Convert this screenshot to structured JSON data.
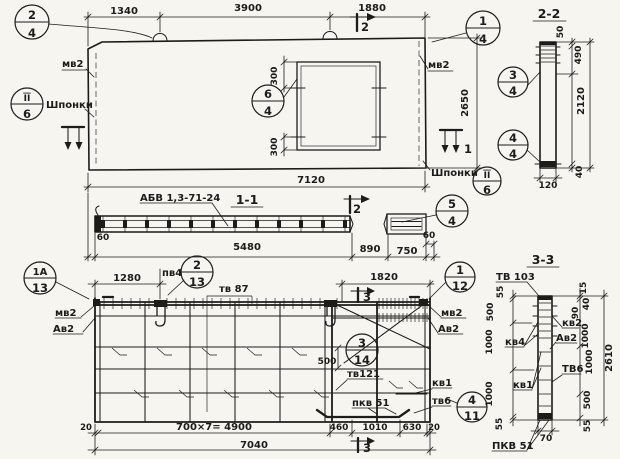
{
  "plan": {
    "d1340": "1340",
    "d3900": "3900",
    "d1880": "1880",
    "d7120": "7120",
    "d2650": "2650",
    "d300a": "300",
    "d300b": "300",
    "mv2_left": "мв2",
    "mv2_right": "мв2",
    "shponki_left": "Шпонки",
    "shponki_right": "Шпонки",
    "m24": {
      "t": "2",
      "b": "4"
    },
    "m14": {
      "t": "1",
      "b": "4"
    },
    "m64": {
      "t": "6",
      "b": "4"
    },
    "k6l": {
      "t": "I̅I̅",
      "b": "6"
    },
    "k6r": {
      "t": "I̅I̅",
      "b": "6"
    },
    "cut1": "1",
    "cut2": "2"
  },
  "s22": {
    "title": "2-2",
    "d50": "50",
    "d490": "490",
    "d2120": "2120",
    "d40": "40",
    "d120": "120",
    "m34": {
      "t": "3",
      "b": "4"
    },
    "m44": {
      "t": "4",
      "b": "4"
    }
  },
  "s11": {
    "title": "1-1",
    "series": "АБВ 1,3-71-24",
    "d60l": "60",
    "d5480": "5480",
    "d890": "890",
    "d750": "750",
    "d60r": "60",
    "m54": {
      "t": "5",
      "b": "4"
    },
    "cut2": "2"
  },
  "grid": {
    "d1280": "1280",
    "d1820": "1820",
    "d500": "500",
    "d20l": "20",
    "d4900": "700×7= 4900",
    "d460": "460",
    "d1010": "1010",
    "d630": "630",
    "d20r": "20",
    "d7040": "7040",
    "pv4": "пв4",
    "tv87": "тв 87",
    "mv2l": "мв2",
    "av2l": "Ав2",
    "mv2r": "мв2",
    "av2r": "Ав2",
    "tv121": "тв121",
    "kv1": "кв1",
    "tv6": "тв6",
    "pkv51": "пкв 51",
    "m1a13": {
      "t": "1А",
      "b": "13"
    },
    "m213": {
      "t": "2",
      "b": "13"
    },
    "m314": {
      "t": "3",
      "b": "14"
    },
    "m112": {
      "t": "1",
      "b": "12"
    },
    "m411": {
      "t": "4",
      "b": "11"
    },
    "cut3_top": "3",
    "cut3_bot": "3"
  },
  "s33": {
    "title": "3-3",
    "tv103": "ТВ 103",
    "kv4": "кв4",
    "kv1": "кв1",
    "pkv51": "ПКВ 51",
    "kv2": "кв2",
    "av2": "Ав2",
    "tv6": "ТВ6",
    "d55t": "55",
    "d500l": "500",
    "d1000la": "1000",
    "d1000lb": "1000",
    "d55lb": "55",
    "d15": "15",
    "d40": "40",
    "d90": "90",
    "d1000ra": "1000",
    "d1000rb": "1000",
    "d500r": "500",
    "d55r": "55",
    "d2610": "2610",
    "d70": "70"
  }
}
